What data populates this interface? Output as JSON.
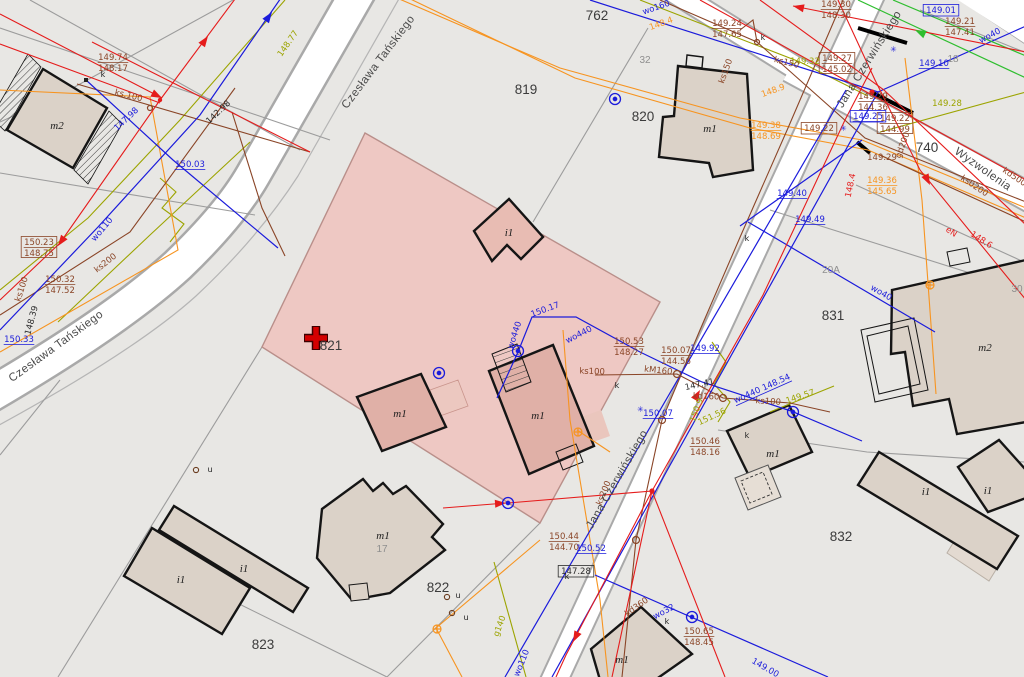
{
  "map": {
    "title": "cadastral-map-view",
    "colors": {
      "brown": "#8a4527",
      "blue": "#1b1bdb",
      "red": "#e51c1c",
      "orange": "#f79420",
      "olive": "#9ca400",
      "green": "#2fbe2f",
      "black": "#2b2b2b",
      "gray": "#8f8f8f",
      "highlight_fill": "#eec5c0",
      "highlight_border": "#b98f8a",
      "building_fill": "#dbd2c8",
      "building_fill_pink": "#e0b0a7",
      "road_fill": "#ffffff",
      "background": "#e8e7e4"
    },
    "selected_parcel": {
      "id": "821",
      "marker": "red-cross",
      "x": 316,
      "y": 338
    },
    "parcel_labels": [
      {
        "t": "762",
        "x": 597,
        "y": 20
      },
      {
        "t": "819",
        "x": 526,
        "y": 94
      },
      {
        "t": "820",
        "x": 643,
        "y": 121
      },
      {
        "t": "821",
        "x": 331,
        "y": 350
      },
      {
        "t": "822",
        "x": 438,
        "y": 592
      },
      {
        "t": "823",
        "x": 263,
        "y": 649
      },
      {
        "t": "831",
        "x": 833,
        "y": 320
      },
      {
        "t": "832",
        "x": 841,
        "y": 541
      },
      {
        "t": "740",
        "x": 927,
        "y": 152
      },
      {
        "t": "32",
        "x": 645,
        "y": 63,
        "sm": 1
      },
      {
        "t": "20A",
        "x": 831,
        "y": 273,
        "sm": 1
      },
      {
        "t": "30",
        "x": 1017,
        "y": 292,
        "sm": 1
      },
      {
        "t": "18",
        "x": 953,
        "y": 62,
        "sm": 1
      },
      {
        "t": "17",
        "x": 382,
        "y": 552,
        "sm": 1
      }
    ],
    "street_labels": [
      {
        "t": "Czesława Tańskiego",
        "x": 381,
        "y": 64,
        "rot": -53
      },
      {
        "t": "Czesława Tańskiego",
        "x": 58,
        "y": 349,
        "rot": -36
      },
      {
        "t": "Jana Czerwińskiego",
        "x": 872,
        "y": 61,
        "rot": -58
      },
      {
        "t": "Jana Czerwińskiego",
        "x": 620,
        "y": 481,
        "rot": -60
      },
      {
        "t": "Wyzwolenia",
        "x": 981,
        "y": 172,
        "rot": 35
      }
    ],
    "building_labels": [
      {
        "t": "m2",
        "x": 57,
        "y": 129
      },
      {
        "t": "m1",
        "x": 710,
        "y": 132
      },
      {
        "t": "i1",
        "x": 509,
        "y": 236
      },
      {
        "t": "m1",
        "x": 538,
        "y": 419
      },
      {
        "t": "m1",
        "x": 400,
        "y": 417
      },
      {
        "t": "m1",
        "x": 383,
        "y": 539
      },
      {
        "t": "i1",
        "x": 181,
        "y": 583
      },
      {
        "t": "i1",
        "x": 244,
        "y": 572
      },
      {
        "t": "m1",
        "x": 773,
        "y": 457
      },
      {
        "t": "m2",
        "x": 985,
        "y": 351
      },
      {
        "t": "i1",
        "x": 926,
        "y": 495
      },
      {
        "t": "i1",
        "x": 988,
        "y": 494
      },
      {
        "t": "m1",
        "x": 622,
        "y": 663
      }
    ],
    "annotations": [
      {
        "t": "149.74",
        "t2": "148.17",
        "x": 113,
        "y": 60,
        "c": "brown"
      },
      {
        "t": "150.23",
        "t2": "148.75",
        "x": 39,
        "y": 245,
        "c": "brown",
        "box": 1
      },
      {
        "t": "150.32",
        "t2": "147.52",
        "x": 60,
        "y": 282,
        "c": "brown"
      },
      {
        "t": "150.53",
        "t2": "148.27",
        "x": 629,
        "y": 344,
        "c": "brown"
      },
      {
        "t": "150.07",
        "t2": "144.56",
        "x": 676,
        "y": 353,
        "c": "brown"
      },
      {
        "t": "150.46",
        "t2": "148.16",
        "x": 705,
        "y": 444,
        "c": "brown"
      },
      {
        "t": "150.44",
        "t2": "144.70",
        "x": 564,
        "y": 539,
        "c": "brown"
      },
      {
        "t": "150.65",
        "t2": "148.45",
        "x": 699,
        "y": 634,
        "c": "brown"
      },
      {
        "t": "149.24",
        "t2": "147.65",
        "x": 727,
        "y": 26,
        "c": "brown"
      },
      {
        "t": "149.27",
        "t2": "145.02",
        "x": 837,
        "y": 61,
        "c": "brown",
        "box": 1
      },
      {
        "t": "149.29",
        "t2": "144.36",
        "x": 873,
        "y": 99,
        "c": "brown"
      },
      {
        "t": "149.22",
        "t2": "144.99",
        "x": 895,
        "y": 121,
        "c": "brown",
        "box": 1
      },
      {
        "t": "149.30",
        "t2": "148.30",
        "x": 836,
        "y": 7,
        "c": "brown"
      },
      {
        "t": "149.21",
        "t2": "147.41",
        "x": 960,
        "y": 24,
        "c": "brown"
      },
      {
        "t": "149.38",
        "t2": "148.69",
        "x": 766,
        "y": 128,
        "c": "orange"
      },
      {
        "t": "149.36",
        "t2": "145.65",
        "x": 882,
        "y": 183,
        "c": "orange"
      },
      {
        "t": "149.29",
        "x": 882,
        "y": 160,
        "c": "brown"
      },
      {
        "t": "149.22",
        "x": 819,
        "y": 131,
        "c": "brown",
        "box": 1
      },
      {
        "t": "150.03",
        "x": 190,
        "y": 167,
        "c": "blue",
        "u": 1
      },
      {
        "t": "150.33",
        "x": 19,
        "y": 342,
        "c": "blue",
        "u": 1
      },
      {
        "t": "150.07",
        "x": 658,
        "y": 416,
        "c": "blue",
        "u": 1
      },
      {
        "t": "150.52",
        "x": 591,
        "y": 551,
        "c": "blue",
        "u": 1
      },
      {
        "t": "149.92",
        "x": 705,
        "y": 351,
        "c": "blue",
        "u": 1
      },
      {
        "t": "149.49",
        "x": 810,
        "y": 222,
        "c": "blue",
        "u": 1
      },
      {
        "t": "149.10",
        "x": 934,
        "y": 66,
        "c": "blue",
        "u": 1
      },
      {
        "t": "149.01",
        "x": 941,
        "y": 13,
        "c": "blue",
        "box": 1
      },
      {
        "t": "149.40",
        "x": 792,
        "y": 196,
        "c": "blue",
        "u": 1
      },
      {
        "t": "149.25",
        "x": 868,
        "y": 119,
        "c": "blue",
        "box": 1,
        "u": 1
      },
      {
        "t": "150.17",
        "x": 546,
        "y": 312,
        "c": "blue",
        "rot": -20
      },
      {
        "t": "149.00",
        "x": 764,
        "y": 670,
        "c": "blue",
        "rot": 30
      },
      {
        "t": "147.98",
        "x": 128,
        "y": 121,
        "c": "blue",
        "rot": -43
      },
      {
        "t": "142.98",
        "x": 220,
        "y": 114,
        "c": "black",
        "rot": -43
      },
      {
        "t": "147.41",
        "x": 700,
        "y": 387,
        "c": "black",
        "rot": -12
      },
      {
        "t": "147.28",
        "x": 576,
        "y": 574,
        "c": "black",
        "box": 1
      },
      {
        "t": "148.39",
        "x": 34,
        "y": 321,
        "c": "black",
        "rot": -75
      },
      {
        "t": "149.32",
        "x": 805,
        "y": 64,
        "c": "olive"
      },
      {
        "t": "149.28",
        "x": 947,
        "y": 106,
        "c": "olive"
      },
      {
        "t": "148.77",
        "x": 290,
        "y": 45,
        "c": "olive",
        "rot": -55
      },
      {
        "t": "149.57",
        "x": 801,
        "y": 399,
        "c": "olive",
        "rot": -18
      },
      {
        "t": "150.9",
        "x": 699,
        "y": 411,
        "c": "olive",
        "rot": -70
      },
      {
        "t": "151.56",
        "x": 713,
        "y": 419,
        "c": "olive",
        "rot": -25
      },
      {
        "t": "148.6",
        "x": 980,
        "y": 242,
        "c": "red",
        "rot": 33
      },
      {
        "t": "148.4",
        "x": 853,
        "y": 186,
        "c": "red",
        "rot": -78
      },
      {
        "t": "eN",
        "x": 950,
        "y": 234,
        "c": "red",
        "rot": 33
      },
      {
        "t": "148.4",
        "x": 662,
        "y": 26,
        "c": "orange",
        "rot": -20
      },
      {
        "t": "148.9",
        "x": 774,
        "y": 93,
        "c": "orange",
        "rot": -20
      },
      {
        "t": "ks.100",
        "x": 128,
        "y": 98,
        "c": "brown",
        "rot": 14
      },
      {
        "t": "ks200",
        "x": 107,
        "y": 265,
        "c": "brown",
        "rot": -38
      },
      {
        "t": "ks150",
        "x": 728,
        "y": 72,
        "c": "brown",
        "rot": -70
      },
      {
        "t": "ks150",
        "x": 786,
        "y": 65,
        "c": "brown",
        "rot": 14
      },
      {
        "t": "ks0200",
        "x": 973,
        "y": 188,
        "c": "brown",
        "rot": 34
      },
      {
        "t": "kd500",
        "x": 1013,
        "y": 179,
        "c": "brown",
        "rot": 34
      },
      {
        "t": "gd200",
        "x": 905,
        "y": 146,
        "c": "brown",
        "rot": -70
      },
      {
        "t": "ks100",
        "x": 592,
        "y": 374,
        "c": "brown",
        "rot": 2
      },
      {
        "t": "kM160",
        "x": 658,
        "y": 373,
        "c": "brown",
        "rot": 6
      },
      {
        "t": "kd160",
        "x": 706,
        "y": 399,
        "c": "brown",
        "rot": 2
      },
      {
        "t": "ks100",
        "x": 768,
        "y": 404,
        "c": "brown",
        "rot": 4
      },
      {
        "t": "kd360",
        "x": 638,
        "y": 609,
        "c": "brown",
        "rot": -35
      },
      {
        "t": "ks200",
        "x": 606,
        "y": 494,
        "c": "brown",
        "rot": -68
      },
      {
        "t": "ks100",
        "x": 24,
        "y": 290,
        "c": "brown",
        "rot": -72
      },
      {
        "t": "wo110",
        "x": 104,
        "y": 231,
        "c": "blue",
        "rot": -50
      },
      {
        "t": "wo160",
        "x": 657,
        "y": 10,
        "c": "blue",
        "rot": -19
      },
      {
        "t": "wo110",
        "x": 524,
        "y": 664,
        "c": "blue",
        "rot": -68
      },
      {
        "t": "wo32",
        "x": 665,
        "y": 614,
        "c": "blue",
        "rot": -28
      },
      {
        "t": "wo440",
        "x": 517,
        "y": 336,
        "c": "blue",
        "rot": -72
      },
      {
        "t": "wo440",
        "x": 580,
        "y": 337,
        "c": "blue",
        "rot": -27
      },
      {
        "t": "wo440 148.54",
        "x": 763,
        "y": 391,
        "c": "blue",
        "rot": -24,
        "u": 1
      },
      {
        "t": "wo40",
        "x": 880,
        "y": 295,
        "c": "blue",
        "rot": 30
      },
      {
        "t": "wo40",
        "x": 991,
        "y": 38,
        "c": "blue",
        "rot": -28
      },
      {
        "t": "g140",
        "x": 502,
        "y": 627,
        "c": "olive",
        "rot": -70
      }
    ],
    "point_marks": [
      {
        "t": "k",
        "x": 103,
        "y": 77
      },
      {
        "t": "k",
        "x": 763,
        "y": 40
      },
      {
        "t": "k",
        "x": 617,
        "y": 388
      },
      {
        "t": "k",
        "x": 567,
        "y": 579
      },
      {
        "t": "k",
        "x": 747,
        "y": 438
      },
      {
        "t": "k",
        "x": 667,
        "y": 624
      },
      {
        "t": "k",
        "x": 747,
        "y": 241
      },
      {
        "t": "u",
        "x": 458,
        "y": 598,
        "c": "brown"
      },
      {
        "t": "u",
        "x": 466,
        "y": 620,
        "c": "brown"
      },
      {
        "t": "u",
        "x": 210,
        "y": 472,
        "c": "brown"
      }
    ]
  }
}
